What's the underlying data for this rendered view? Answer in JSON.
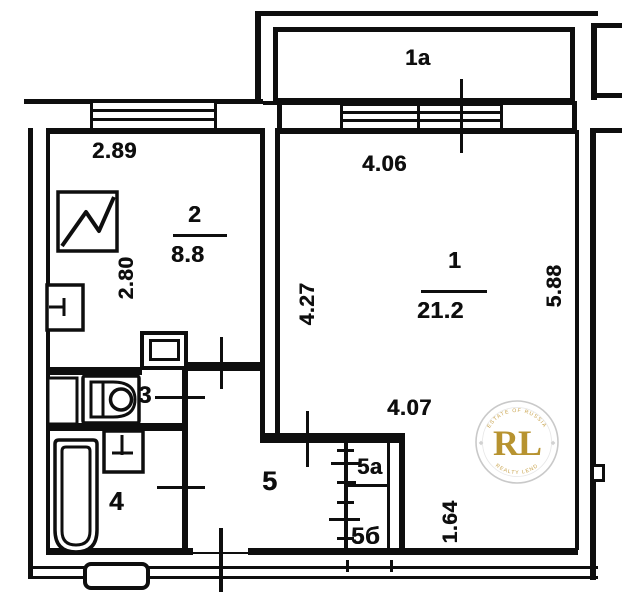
{
  "plan_title": "Apartment floor plan",
  "rooms": {
    "balcony": {
      "label": "1a"
    },
    "living": {
      "number": "1",
      "area": "21.2"
    },
    "kitchen": {
      "number": "2",
      "area": "8.8"
    },
    "wc": {
      "label": "3"
    },
    "bath": {
      "label": "4"
    },
    "hall": {
      "label": "5"
    },
    "closet_a": {
      "label": "5a"
    },
    "closet_b": {
      "label": "5б"
    }
  },
  "dimensions": {
    "kitchen_top": "2.89",
    "kitchen_left": "2.80",
    "living_top": "4.06",
    "living_left": "4.27",
    "living_right": "5.88",
    "living_bottom": "4.07",
    "ext_right": "1.64"
  },
  "watermark": {
    "initials": "RL",
    "top_arc": "ESTATE OF RUSSIA",
    "bottom_arc": "REALTY LEND",
    "gold": "#b79330",
    "ring": "#c9c9c9"
  },
  "colors": {
    "line": "#0e0e0e",
    "background": "#ffffff"
  }
}
